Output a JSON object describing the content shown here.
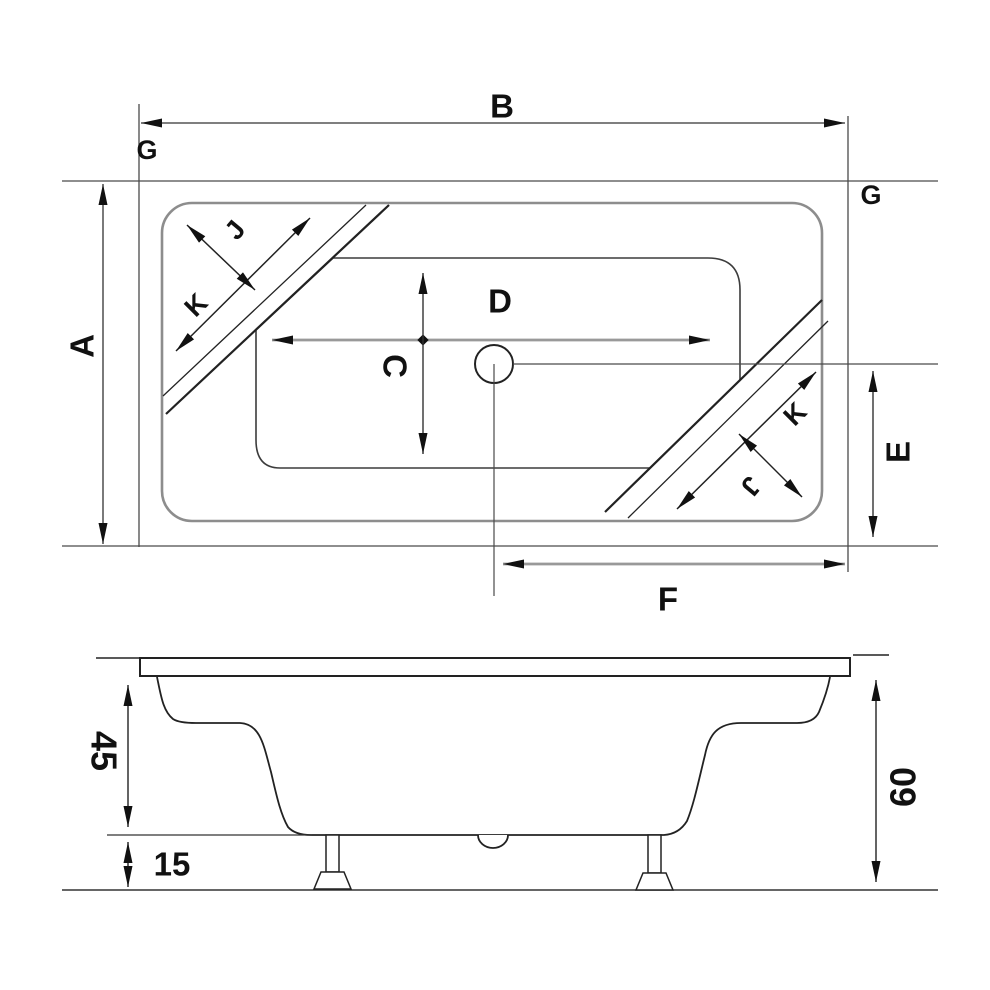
{
  "figure": {
    "description": "Technical dimension drawing of a rectangular bathtub, top view and side view",
    "background_color": "#ffffff",
    "line_color": "#2b2b2b",
    "gray_line_color": "#8d8d8d"
  },
  "plan_view": {
    "name": "bathtub-top-view",
    "dim_overall_length": "B",
    "dim_overall_width": "A",
    "dim_rim_left": "G",
    "dim_rim_right": "G",
    "dim_inner_length": "D",
    "dim_inner_width": "C",
    "dim_drain_to_edge": "E",
    "dim_drain_to_end": "F",
    "dim_corner_diagonal_topleft": "K",
    "dim_corner_band_width_topleft": "J",
    "dim_corner_diagonal_bottomright": "K",
    "dim_corner_band_width_bottomright": "J"
  },
  "side_view": {
    "name": "bathtub-side-view",
    "dim_body_height": "45",
    "dim_leg_clearance": "15",
    "dim_total_height": "60"
  }
}
